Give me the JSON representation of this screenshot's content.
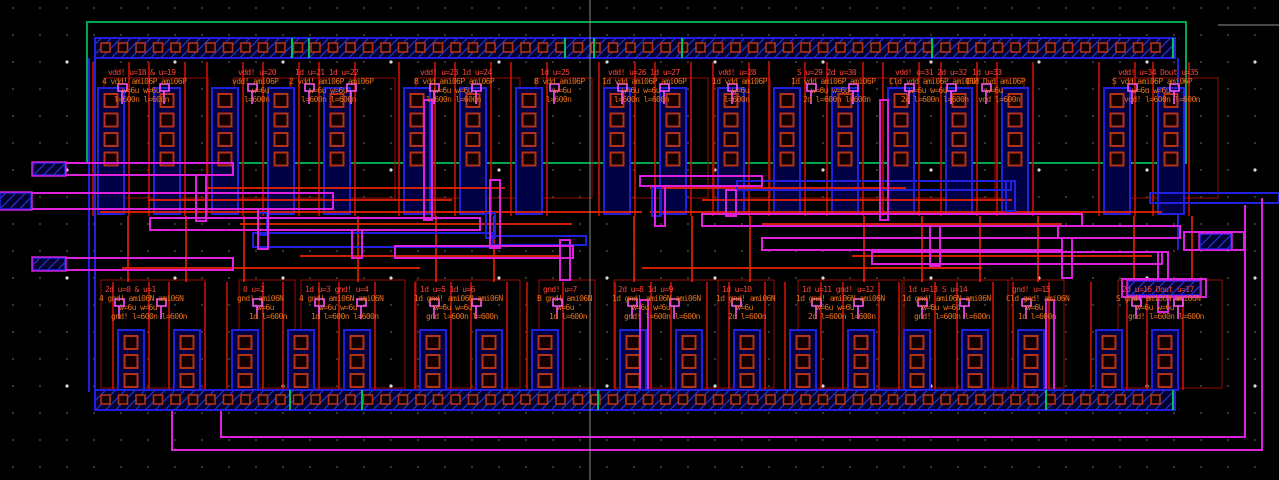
{
  "app": {
    "title": "IC Layout Editor Canvas",
    "cell_technology": "ami06"
  },
  "canvas": {
    "width": 1279,
    "height": 480,
    "background": "#000000"
  },
  "colors": {
    "metal1": "#2020dd",
    "metal1_fill": "#000044",
    "hatch_bg": "#000030",
    "hatch_line": "#2a3bd0",
    "poly": "#cc1100",
    "poly_bright": "#ee2200",
    "metal2": "#dd22dd",
    "metal2_bright": "#ff55ff",
    "contact": "#b43314",
    "contact_fill": "#150000",
    "nwell_boundary": "#00a550",
    "rail_tick": "#00c060",
    "text_instance": "#ff4136",
    "text_param": "#e8701a",
    "grid_dot": "#3a3a3a",
    "grid_dot_major": "#d8d8d8",
    "crosshair": "#8a8a8a"
  },
  "grid": {
    "pitch": 27,
    "major_pitch": 108
  },
  "crosshair": {
    "vline_x": 590,
    "hline_y": 25,
    "hline_x1": 1218,
    "hline_x2": 1279
  },
  "boundary": {
    "x": 87,
    "y": 22,
    "w": 1099,
    "h": 141
  },
  "rails": [
    {
      "name": "vdd-rail",
      "x": 95,
      "y": 38,
      "w": 1080,
      "h": 20
    },
    {
      "name": "gnd-rail",
      "x": 95,
      "y": 390,
      "w": 1080,
      "h": 20
    }
  ],
  "rail_contacts": {
    "start_x": 101,
    "end_x": 1168,
    "pitch": 17.5,
    "size": 9,
    "inset_y": 5
  },
  "rail_ticks": {
    "top": [
      292,
      309,
      565,
      594,
      682,
      932,
      1173
    ],
    "bottom": [
      290,
      362,
      598,
      1046,
      1173
    ]
  },
  "columns": {
    "top": {
      "xs": [
        98,
        154,
        212,
        268,
        324,
        404,
        460,
        516,
        604,
        660,
        718,
        774,
        832,
        888,
        946,
        1002,
        1104,
        1158
      ],
      "y": 88,
      "h": 126,
      "w": 26,
      "contacts": 4,
      "contact_pitch": 19.5,
      "contact_size": 13
    },
    "bottom": {
      "xs": [
        118,
        174,
        232,
        288,
        344,
        420,
        476,
        532,
        620,
        676,
        734,
        790,
        848,
        904,
        962,
        1018,
        1096,
        1152
      ],
      "y": 330,
      "h": 60,
      "w": 26,
      "contacts": 3,
      "contact_pitch": 19,
      "contact_size": 13
    }
  },
  "edge_lines": {
    "blue": [
      [
        89,
        58,
        89,
        392
      ],
      [
        95,
        58,
        95,
        392
      ],
      [
        1178,
        58,
        1178,
        250
      ]
    ]
  },
  "poly": {
    "top_span": [
      62,
      216
    ],
    "bottom_span": [
      282,
      390
    ],
    "offsets": [
      -5,
      31
    ],
    "cross_xs": [
      128,
      186,
      244,
      358,
      436,
      494,
      634,
      692,
      750,
      864,
      922,
      980,
      1038,
      1134,
      1192
    ],
    "cross_span": [
      216,
      282
    ],
    "channel_lines": [
      [
        207,
        188,
        505,
        188
      ],
      [
        148,
        200,
        452,
        200
      ],
      [
        100,
        212,
        642,
        212
      ],
      [
        240,
        224,
        572,
        224
      ],
      [
        300,
        256,
        560,
        256
      ],
      [
        122,
        268,
        420,
        268
      ],
      [
        650,
        188,
        906,
        188
      ],
      [
        702,
        200,
        1012,
        200
      ],
      [
        650,
        212,
        1162,
        212
      ],
      [
        762,
        224,
        1062,
        224
      ],
      [
        852,
        256,
        1152,
        256
      ],
      [
        642,
        268,
        982,
        268
      ]
    ]
  },
  "metal2_rects": [
    [
      65,
      163,
      168,
      12
    ],
    [
      31,
      193,
      302,
      16
    ],
    [
      65,
      258,
      168,
      12
    ],
    [
      150,
      218,
      330,
      12
    ],
    [
      395,
      246,
      178,
      12
    ],
    [
      640,
      176,
      122,
      10
    ],
    [
      702,
      214,
      380,
      12
    ],
    [
      762,
      238,
      300,
      12
    ],
    [
      872,
      252,
      290,
      12
    ],
    [
      1058,
      226,
      122,
      12
    ],
    [
      1184,
      232,
      60,
      18
    ],
    [
      1122,
      279,
      84,
      18
    ],
    [
      196,
      175,
      10,
      46
    ],
    [
      258,
      209,
      10,
      40
    ],
    [
      352,
      230,
      10,
      28
    ],
    [
      490,
      180,
      10,
      68
    ],
    [
      560,
      240,
      10,
      40
    ],
    [
      655,
      186,
      10,
      40
    ],
    [
      726,
      190,
      10,
      26
    ],
    [
      930,
      226,
      10,
      40
    ],
    [
      1062,
      238,
      10,
      40
    ],
    [
      1158,
      252,
      10,
      60
    ],
    [
      424,
      100,
      8,
      120
    ],
    [
      880,
      100,
      8,
      120
    ],
    [
      640,
      300,
      8,
      90
    ],
    [
      1046,
      300,
      8,
      90
    ]
  ],
  "metal2_paths": [
    "M172,408 L172,450 L1262,450 L1262,198",
    "M221,408 L221,437 L1245,437 L1245,205"
  ],
  "metal1_wires": [
    [
      253,
      233,
      240,
      14
    ],
    [
      490,
      236,
      96,
      9
    ],
    [
      737,
      181,
      274,
      9
    ],
    [
      1150,
      193,
      129,
      10
    ],
    [
      258,
      213,
      9,
      22
    ],
    [
      486,
      213,
      9,
      25
    ],
    [
      652,
      188,
      9,
      28
    ],
    [
      1006,
      181,
      9,
      30
    ]
  ],
  "pins": [
    {
      "name": "input-pin-1",
      "x": 33,
      "y": 163,
      "w": 32,
      "h": 12
    },
    {
      "name": "input-pin-2",
      "x": 0,
      "y": 193,
      "w": 31,
      "h": 16
    },
    {
      "name": "input-pin-3",
      "x": 33,
      "y": 258,
      "w": 32,
      "h": 12
    },
    {
      "name": "output-pin-1",
      "x": 1200,
      "y": 234,
      "w": 31,
      "h": 15
    },
    {
      "name": "output-pin-2",
      "x": 1128,
      "y": 281,
      "w": 72,
      "h": 14
    }
  ],
  "device_labels": {
    "top": [
      {
        "x": 108,
        "y": 68,
        "dual": true,
        "lines": [
          "vdd! u=18 & u=19",
          "4 vdd! ami06P ami06P",
          "w=6u  w=6u",
          "l=600n l=600n"
        ]
      },
      {
        "x": 238,
        "y": 68,
        "dual": false,
        "lines": [
          "vdd! u=20",
          "vdd! ami06P",
          "w=6u",
          "l=600n"
        ]
      },
      {
        "x": 295,
        "y": 68,
        "dual": true,
        "lines": [
          "1d u=21 1d u=22",
          "2 vdd! ami06P ami06P",
          "w=6u  w=6u",
          "l=600n l=600n"
        ]
      },
      {
        "x": 420,
        "y": 68,
        "dual": true,
        "lines": [
          "vdd! u=23 1d u=24",
          "B vdd ami06P ami06P",
          "w=6u  w=6u",
          "l=600n l=600n"
        ]
      },
      {
        "x": 540,
        "y": 68,
        "dual": false,
        "lines": [
          "1d u=25",
          "B vdd ami06P",
          "w=6u",
          "l=600n"
        ]
      },
      {
        "x": 608,
        "y": 68,
        "dual": true,
        "lines": [
          "vdd! u=26 1d u=27",
          "1d vdd ami06P ami06P",
          "w=6u  w=6u",
          "l=600n l=600n"
        ]
      },
      {
        "x": 718,
        "y": 68,
        "dual": false,
        "lines": [
          "vdd! u=28",
          "1d vdd ami06P",
          "w=6u",
          "l=600n"
        ]
      },
      {
        "x": 797,
        "y": 68,
        "dual": true,
        "lines": [
          "S u=29 2d u=30",
          "1d vdd ami06P ami06P",
          "w=6u  w=6u",
          "2d l=600n l=600n"
        ]
      },
      {
        "x": 895,
        "y": 68,
        "dual": true,
        "lines": [
          "vdd! u=31 2d u=32",
          "Cld vdd ami06P ami06P",
          "w=6u  w=6u",
          "2d l=600n l=600n"
        ]
      },
      {
        "x": 972,
        "y": 68,
        "dual": false,
        "lines": [
          "1d u=33",
          "Cld Dvd ami06P",
          "w=6u",
          "vdd l=600n"
        ]
      },
      {
        "x": 1118,
        "y": 68,
        "dual": true,
        "lines": [
          "vdd! u=34 Dout u=35",
          "S vdd ami06P ami06P",
          "w=6u  w=6u",
          "vdd! l=600n l=600n"
        ]
      }
    ],
    "bottom": [
      {
        "x": 105,
        "y": 285,
        "dual": true,
        "lines": [
          "2d u=0 & u=1",
          "4 gnd! ami06N ami06N",
          "w=6u  w=6u",
          "gnd! l=600n l=600n"
        ]
      },
      {
        "x": 243,
        "y": 285,
        "dual": false,
        "lines": [
          "0 u=2",
          "gnd! ami06N",
          "w=6u",
          "1d l=600n"
        ]
      },
      {
        "x": 305,
        "y": 285,
        "dual": true,
        "lines": [
          "1d u=3 gnd! u=4",
          "4 gnd! ami06N ami06N",
          "w=6u  w=6u",
          "1d l=600n l=600n"
        ]
      },
      {
        "x": 420,
        "y": 285,
        "dual": true,
        "lines": [
          "1d u=5 1d u=6",
          "1d gnd! ami06N ami06N",
          "w=6u  w=6u",
          "gnd l=600n l=600n"
        ]
      },
      {
        "x": 543,
        "y": 285,
        "dual": false,
        "lines": [
          "gnd! u=7",
          "B gnd! ami06N",
          "w=6u",
          "1d l=600n"
        ]
      },
      {
        "x": 618,
        "y": 285,
        "dual": true,
        "lines": [
          "2d u=8 1d u=9",
          "1d gnd! ami06N ami06N",
          "w=6u  w=6u",
          "gnd! l=600n l=600n"
        ]
      },
      {
        "x": 722,
        "y": 285,
        "dual": false,
        "lines": [
          "1d u=10",
          "1d gnd! ami06N",
          "w=6u",
          "2d l=600n"
        ]
      },
      {
        "x": 802,
        "y": 285,
        "dual": true,
        "lines": [
          "1d u=11 gnd! u=12",
          "1d gnd! ami06N ami06N",
          "w=6u  w=6u",
          "2d l=600n l=600n"
        ]
      },
      {
        "x": 908,
        "y": 285,
        "dual": true,
        "lines": [
          "1d u=13 S u=14",
          "1d gnd! ami06N ami06N",
          "w=6u  w=6u",
          "gnd! l=600n l=600n"
        ]
      },
      {
        "x": 1012,
        "y": 285,
        "dual": false,
        "lines": [
          "gnd! u=15",
          "Cld gnd! ami06N",
          "w=6u",
          "1d l=600n"
        ]
      },
      {
        "x": 1122,
        "y": 285,
        "dual": true,
        "lines": [
          "2d u=16 Dout u=17",
          "S gnd! ami06N ami06N",
          "w=6u  w=6u",
          "gnd! l=600n l=600n"
        ]
      }
    ]
  }
}
